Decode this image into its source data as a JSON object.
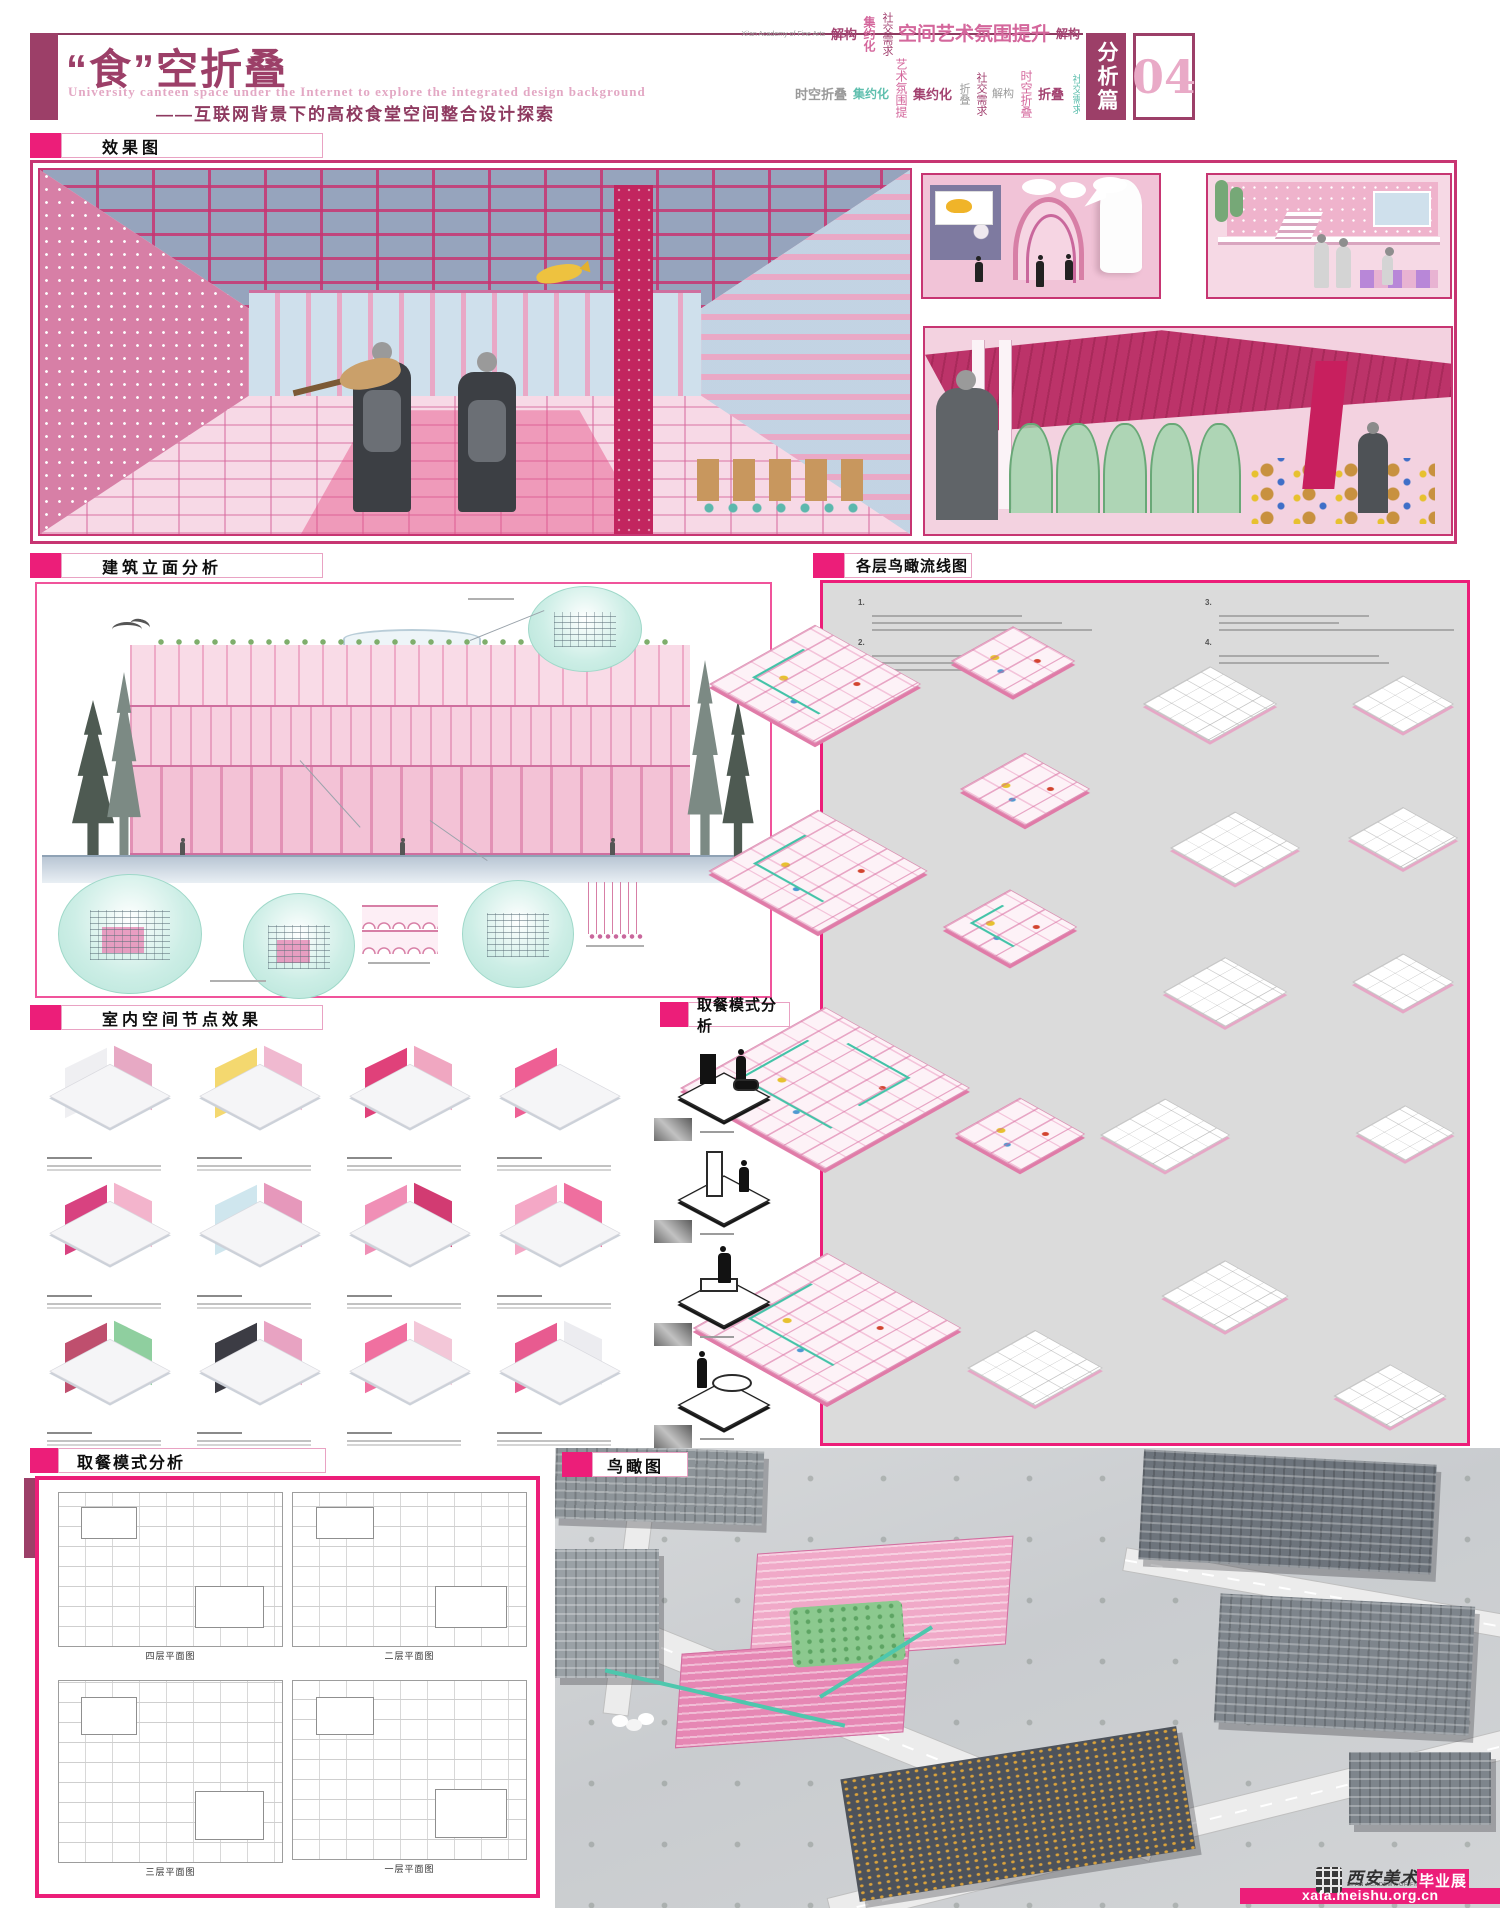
{
  "header": {
    "title": "“食”空折叠",
    "subtitle_en": "University canteen space under the Internet to explore the integrated design background",
    "subtitle_zh": "——互联网背景下的高校食堂空间整合设计探索",
    "chapter_badge": "分析篇",
    "chapter_number": "04",
    "wordcloud": [
      {
        "text": "Xi'an Academy of Fine Arts",
        "color": "gray",
        "size": 7,
        "bold": false,
        "vertical": false
      },
      {
        "text": "解构",
        "color": "maroon",
        "size": 13,
        "bold": true,
        "vertical": false
      },
      {
        "text": "集约化",
        "color": "pink",
        "size": 12,
        "bold": true,
        "vertical": true
      },
      {
        "text": "社交需求",
        "color": "maroon",
        "size": 11,
        "bold": false,
        "vertical": true
      },
      {
        "text": "空间艺术氛围提升",
        "color": "pink",
        "size": 19,
        "bold": true,
        "vertical": false
      },
      {
        "text": "解构",
        "color": "maroon",
        "size": 12,
        "bold": true,
        "vertical": false
      },
      {
        "text": "时空折叠",
        "color": "gray",
        "size": 13,
        "bold": true,
        "vertical": false
      },
      {
        "text": "集约化",
        "color": "teal",
        "size": 12,
        "bold": true,
        "vertical": false
      },
      {
        "text": "艺术氛围提升",
        "color": "pink",
        "size": 12,
        "bold": false,
        "vertical": true
      },
      {
        "text": "集约化",
        "color": "maroon",
        "size": 13,
        "bold": true,
        "vertical": false
      },
      {
        "text": "折叠",
        "color": "gray",
        "size": 11,
        "bold": false,
        "vertical": true
      },
      {
        "text": "社交需求",
        "color": "maroon",
        "size": 11,
        "bold": false,
        "vertical": true
      },
      {
        "text": "解构",
        "color": "gray",
        "size": 11,
        "bold": false,
        "vertical": false
      },
      {
        "text": "时空折叠",
        "color": "pink",
        "size": 12,
        "bold": false,
        "vertical": true
      },
      {
        "text": "折叠",
        "color": "maroon",
        "size": 13,
        "bold": true,
        "vertical": false
      },
      {
        "text": "社交需求",
        "color": "teal",
        "size": 10,
        "bold": false,
        "vertical": true
      },
      {
        "text": "艺术氛围提升",
        "color": "pink",
        "size": 13,
        "bold": false,
        "vertical": false
      },
      {
        "text": "折叠",
        "color": "maroon",
        "size": 14,
        "bold": true,
        "vertical": false
      },
      {
        "text": "艺术氛围提升",
        "color": "pink",
        "size": 13,
        "bold": false,
        "vertical": false
      },
      {
        "text": "折叠",
        "color": "maroon",
        "size": 13,
        "bold": true,
        "vertical": false
      }
    ]
  },
  "section_labels": {
    "renders": "效果图",
    "elevation": "建筑立面分析",
    "circulation": "各层鸟瞰流线图",
    "interior_nodes": "室内空间节点效果",
    "dining_modes": "取餐模式分析",
    "floor_plans": "取餐模式分析",
    "aerial": "鸟瞰图"
  },
  "circulation_notes": {
    "item_numbers": [
      "1.",
      "2.",
      "3.",
      "4."
    ]
  },
  "floor_plan_captions": [
    "四层平面图",
    "二层平面图",
    "三层平面图",
    "一层平面图"
  ],
  "watermark": {
    "school_name": "西安美术学院",
    "school_name_en": "XI'AN ACADEMY OF FINE ARTS",
    "badge": "毕业展",
    "url": "xafa.meishu.org.cn"
  },
  "colors": {
    "accent_pink": "#ec1e79",
    "maroon": "#9c3f68",
    "panel_border": "#c73572",
    "teal": "#49c7ae",
    "gray_panel": "#dbdbdb"
  }
}
